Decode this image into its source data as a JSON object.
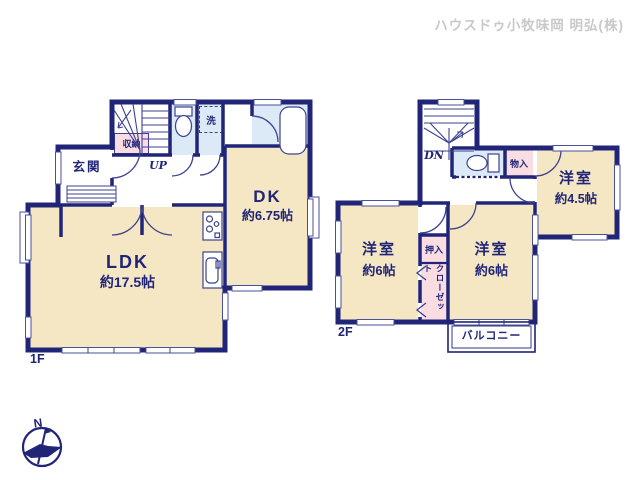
{
  "header": {
    "company_label": "ハウスドゥ小牧味岡 明弘(株)"
  },
  "floor_1f": {
    "floor_label": "1F",
    "ldk": {
      "name": "LDK",
      "area": "約17.5帖"
    },
    "dk": {
      "name": "DK",
      "area": "約6.75帖"
    },
    "genkan_label": "玄関",
    "storage_label": "収納",
    "laundry_label": "洗",
    "stairs_label": "UP"
  },
  "floor_2f": {
    "floor_label": "2F",
    "room_45": {
      "name": "洋室",
      "area": "約4.5帖"
    },
    "room_6_left": {
      "name": "洋室",
      "area": "約6帖"
    },
    "room_6_right": {
      "name": "洋室",
      "area": "約6帖"
    },
    "monoire_label": "物入",
    "oshiire_label": "押入",
    "closet_label": "クローゼット",
    "balcony_label": "バルコニー",
    "stairs_label": "DN"
  },
  "compass": {
    "north_label": "N"
  },
  "colors": {
    "wall": "#202578",
    "line": "#3c4291",
    "window_line": "#4a519c",
    "room_beige": "#f6e7c4",
    "wet_blue": "#dce9f6",
    "closet_pink": "#fadde3",
    "header_gray": "#c9c9c9"
  }
}
